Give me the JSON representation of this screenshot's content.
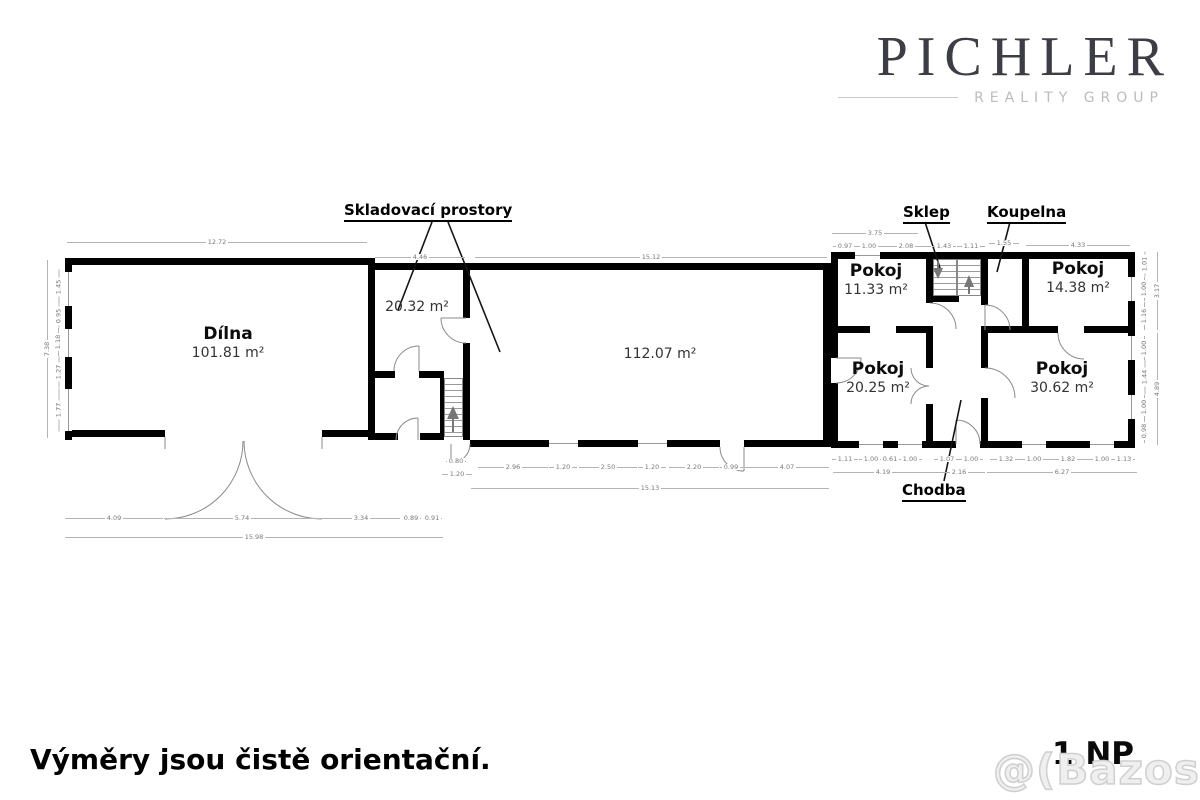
{
  "brand": {
    "name": "PICHLER",
    "tagline": "REALITY GROUP"
  },
  "floor_plan": {
    "callouts": {
      "storage": "Skladovací prostory",
      "cellar": "Sklep",
      "bathroom": "Koupelna",
      "hallway": "Chodba"
    },
    "rooms": [
      {
        "name": "Dílna",
        "area": "101.81 m²",
        "x": 228,
        "y": 325
      },
      {
        "name": "",
        "area": "20.32 m²",
        "x": 417,
        "y": 298
      },
      {
        "name": "",
        "area": "112.07 m²",
        "x": 660,
        "y": 345
      },
      {
        "name": "Pokoj",
        "area": "11.33 m²",
        "x": 876,
        "y": 262
      },
      {
        "name": "Pokoj",
        "area": "14.38 m²",
        "x": 1078,
        "y": 260
      },
      {
        "name": "Pokoj",
        "area": "20.25 m²",
        "x": 878,
        "y": 360
      },
      {
        "name": "Pokoj",
        "area": "30.62 m²",
        "x": 1062,
        "y": 360
      }
    ],
    "dimensions": [
      {
        "v": "12.72",
        "x": 217,
        "y": 242,
        "len": 300,
        "o": "h"
      },
      {
        "v": "4.46",
        "x": 420,
        "y": 257,
        "len": 90,
        "o": "h"
      },
      {
        "v": "15.12",
        "x": 651,
        "y": 257,
        "len": 352,
        "o": "h"
      },
      {
        "v": "3.75",
        "x": 875,
        "y": 233,
        "len": 86,
        "o": "h"
      },
      {
        "v": "0.97",
        "x": 845,
        "y": 246,
        "len": 24,
        "o": "h"
      },
      {
        "v": "1.00",
        "x": 869,
        "y": 246,
        "len": 24,
        "o": "h"
      },
      {
        "v": "2.08",
        "x": 906,
        "y": 246,
        "len": 50,
        "o": "h"
      },
      {
        "v": "1.43",
        "x": 944,
        "y": 246,
        "len": 24,
        "o": "h"
      },
      {
        "v": "1.11",
        "x": 971,
        "y": 246,
        "len": 28,
        "o": "h"
      },
      {
        "v": "1.55",
        "x": 1004,
        "y": 243,
        "len": 30,
        "o": "h"
      },
      {
        "v": "4.33",
        "x": 1078,
        "y": 245,
        "len": 104,
        "o": "h"
      },
      {
        "v": "7.38",
        "x": 47,
        "y": 349,
        "len": 178,
        "o": "v"
      },
      {
        "v": "1.45",
        "x": 58,
        "y": 287,
        "len": 35,
        "o": "v"
      },
      {
        "v": "0.95",
        "x": 58,
        "y": 316,
        "len": 23,
        "o": "v"
      },
      {
        "v": "1.18",
        "x": 58,
        "y": 342,
        "len": 28,
        "o": "v"
      },
      {
        "v": "1.27",
        "x": 58,
        "y": 372,
        "len": 31,
        "o": "v"
      },
      {
        "v": "1.77",
        "x": 58,
        "y": 410,
        "len": 43,
        "o": "v"
      },
      {
        "v": "1.01",
        "x": 1144,
        "y": 264,
        "len": 25,
        "o": "v"
      },
      {
        "v": "1.00",
        "x": 1144,
        "y": 289,
        "len": 24,
        "o": "v"
      },
      {
        "v": "1.16",
        "x": 1144,
        "y": 316,
        "len": 28,
        "o": "v"
      },
      {
        "v": "3.17",
        "x": 1157,
        "y": 291,
        "len": 78,
        "o": "v"
      },
      {
        "v": "1.00",
        "x": 1144,
        "y": 348,
        "len": 24,
        "o": "v"
      },
      {
        "v": "1.44",
        "x": 1144,
        "y": 377,
        "len": 35,
        "o": "v"
      },
      {
        "v": "1.00",
        "x": 1144,
        "y": 407,
        "len": 24,
        "o": "v"
      },
      {
        "v": "0.98",
        "x": 1144,
        "y": 431,
        "len": 24,
        "o": "v"
      },
      {
        "v": "4.89",
        "x": 1157,
        "y": 389,
        "len": 112,
        "o": "v"
      },
      {
        "v": "0.80",
        "x": 456,
        "y": 461,
        "len": 20,
        "o": "h"
      },
      {
        "v": "1.20",
        "x": 457,
        "y": 474,
        "len": 30,
        "o": "h"
      },
      {
        "v": "2.96",
        "x": 513,
        "y": 467,
        "len": 70,
        "o": "h"
      },
      {
        "v": "1.20",
        "x": 563,
        "y": 467,
        "len": 28,
        "o": "h"
      },
      {
        "v": "2.50",
        "x": 608,
        "y": 467,
        "len": 58,
        "o": "h"
      },
      {
        "v": "1.20",
        "x": 652,
        "y": 467,
        "len": 28,
        "o": "h"
      },
      {
        "v": "2.20",
        "x": 694,
        "y": 467,
        "len": 50,
        "o": "h"
      },
      {
        "v": "0.99",
        "x": 731,
        "y": 467,
        "len": 23,
        "o": "h"
      },
      {
        "v": "4.07",
        "x": 787,
        "y": 467,
        "len": 84,
        "o": "h"
      },
      {
        "v": "15.13",
        "x": 650,
        "y": 488,
        "len": 358,
        "o": "h"
      },
      {
        "v": "1.11",
        "x": 845,
        "y": 459,
        "len": 26,
        "o": "h"
      },
      {
        "v": "1.00",
        "x": 871,
        "y": 459,
        "len": 24,
        "o": "h"
      },
      {
        "v": "0.61",
        "x": 890,
        "y": 459,
        "len": 14,
        "o": "h"
      },
      {
        "v": "1.00",
        "x": 910,
        "y": 459,
        "len": 24,
        "o": "h"
      },
      {
        "v": "4.19",
        "x": 883,
        "y": 472,
        "len": 100,
        "o": "h"
      },
      {
        "v": "1.07",
        "x": 947,
        "y": 459,
        "len": 26,
        "o": "h"
      },
      {
        "v": "1.00",
        "x": 971,
        "y": 459,
        "len": 24,
        "o": "h"
      },
      {
        "v": "2.16",
        "x": 959,
        "y": 472,
        "len": 52,
        "o": "h"
      },
      {
        "v": "1.32",
        "x": 1006,
        "y": 459,
        "len": 32,
        "o": "h"
      },
      {
        "v": "1.00",
        "x": 1034,
        "y": 459,
        "len": 24,
        "o": "h"
      },
      {
        "v": "1.82",
        "x": 1068,
        "y": 459,
        "len": 44,
        "o": "h"
      },
      {
        "v": "1.00",
        "x": 1102,
        "y": 459,
        "len": 24,
        "o": "h"
      },
      {
        "v": "1.13",
        "x": 1124,
        "y": 459,
        "len": 22,
        "o": "h"
      },
      {
        "v": "6.27",
        "x": 1062,
        "y": 472,
        "len": 150,
        "o": "h"
      },
      {
        "v": "4.09",
        "x": 114,
        "y": 518,
        "len": 98,
        "o": "h"
      },
      {
        "v": "5.74",
        "x": 242,
        "y": 518,
        "len": 157,
        "o": "h"
      },
      {
        "v": "3.34",
        "x": 361,
        "y": 518,
        "len": 78,
        "o": "h"
      },
      {
        "v": "0.89",
        "x": 411,
        "y": 518,
        "len": 19,
        "o": "h"
      },
      {
        "v": "0.91",
        "x": 432,
        "y": 518,
        "len": 19,
        "o": "h"
      },
      {
        "v": "15.98",
        "x": 254,
        "y": 537,
        "len": 378,
        "o": "h"
      }
    ]
  },
  "footer": {
    "note": "Výměry jsou čistě orientační.",
    "floor_label": "1.NP",
    "watermark": "@(Bazos.cz"
  }
}
